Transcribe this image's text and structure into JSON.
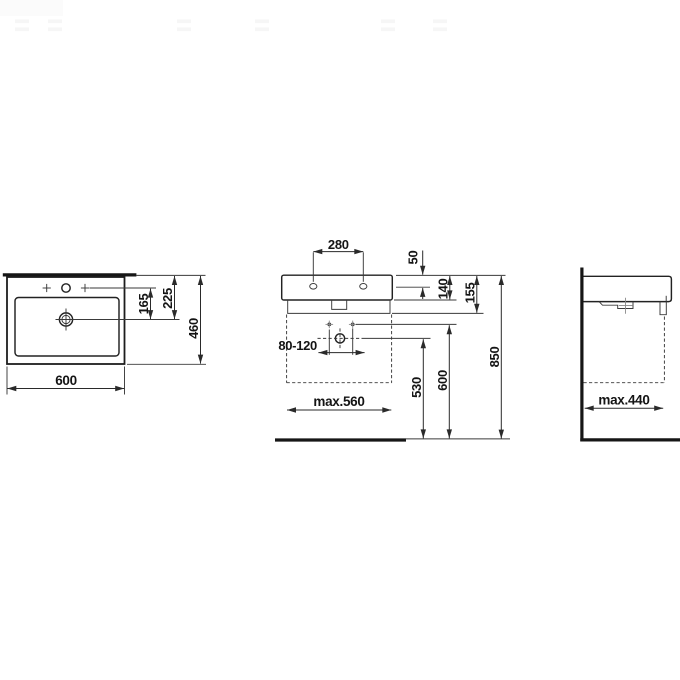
{
  "drawing": {
    "type": "technical-drawing",
    "subject": "wall-mounted washbasin, three orthographic views with installation dimensions",
    "colors": {
      "line": "#222222",
      "text": "#141414",
      "background": "#ffffff"
    },
    "views": {
      "plan": {
        "width": "600",
        "depth": "460",
        "rear_to_drain": "225",
        "tap_to_drain": "165"
      },
      "front": {
        "tap_spacing": "280",
        "rim_to_tap_holes": "50",
        "tap_to_underside": "140",
        "body_height": "155",
        "rim_height_above_floor": "850",
        "fixing_holes_height": "600",
        "drain_height": "530",
        "trap_offset_range": "80-120",
        "max_clearance_width": "max.560"
      },
      "side": {
        "max_clearance_depth": "max.440"
      }
    }
  }
}
